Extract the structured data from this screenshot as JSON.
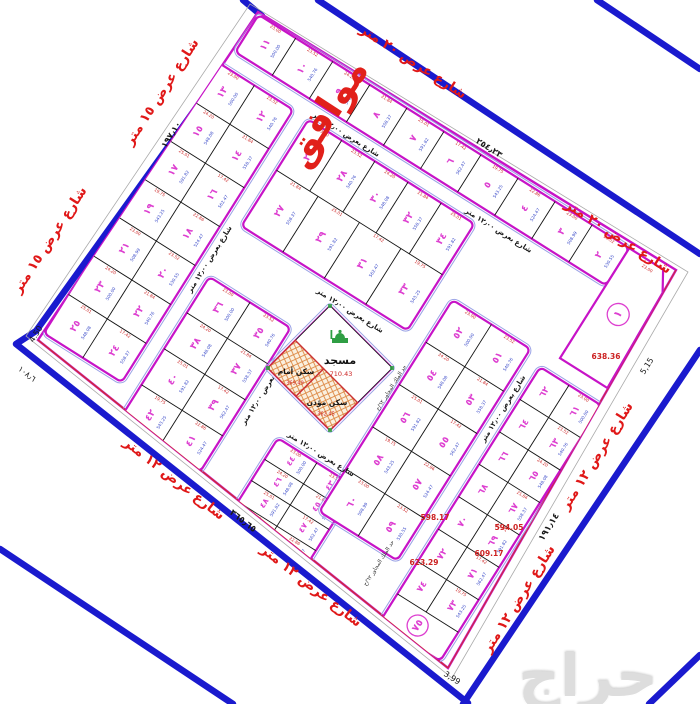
{
  "map": {
    "approval_stamp": "موافق",
    "watermark": "حراج",
    "street_names": {
      "top_20m": "شارع عرض ٢٠ متر",
      "left_15m": "شارع عرض ١٥ متر",
      "bottom_12m": "شارع عرض ١٢ متر",
      "right_12m": "شارع عرض ١٢ متر",
      "internal_12m": "شارع بعرض ١٢٫٠٠ متر"
    },
    "boundary_note": "حد الملك المجاور ٦٢/ح",
    "edge_measurements": {
      "top": "٢٥٤٫٢٣",
      "left": "١٩٧٫١٠",
      "bottom": "٣٦٥٫٦٥",
      "bottom_near_corner": "١٠٨٫٦",
      "right": "١٩١٫١٤",
      "corner_right": "5,15",
      "corner_bottom": "3,99",
      "corner_left": "4.50"
    },
    "mosque": {
      "label": "مسجد",
      "area": "710.43",
      "imam_house": "سكن أمام",
      "imam_area": "369.49",
      "muezzin_house": "سكن مؤذن",
      "muezzin_area": "362.45"
    },
    "blocks": {
      "top_row": [
        "١١",
        "١٠",
        "٩",
        "٨",
        "٧",
        "٦",
        "٥",
        "٤",
        "٣",
        "٢"
      ],
      "corner_plot": "١",
      "left_strip": [
        [
          "١٣",
          "١٢"
        ],
        [
          "١٥",
          "١٤"
        ],
        [
          "١٧",
          "١٦"
        ],
        [
          "١٩",
          "١٨"
        ],
        [
          "٢١",
          "٢٠"
        ],
        [
          "٢٣",
          "٢٢"
        ],
        [
          "٢٥",
          "٢٤"
        ]
      ],
      "mid_upper_top": [
        "٢٦",
        "٢٨",
        "٣٠",
        "٣٢",
        "٣٤"
      ],
      "mid_upper_bottom": [
        "٢٧",
        "٢٩",
        "٣١",
        "٣٣"
      ],
      "mid_lower": [
        [
          "٣٦",
          "٣٥"
        ],
        [
          "٣٨",
          "٣٧"
        ],
        [
          "٤٠",
          "٣٩"
        ],
        [
          "٤٢",
          "٤١"
        ]
      ],
      "south_mid": [
        [
          "٤٤",
          "٤٣"
        ],
        [
          "٤٦",
          "٤٥"
        ],
        [
          "٤٨",
          "٤٧"
        ],
        [
          "٥٠",
          "٤٩"
        ]
      ],
      "east_mid": [
        [
          "٥٢",
          "٥١"
        ],
        [
          "٥٤",
          "٥٣"
        ],
        [
          "٥٦",
          "٥٥"
        ],
        [
          "٥٨",
          "٥٧"
        ],
        [
          "٦٠",
          "٥٩"
        ]
      ],
      "east_strip": [
        [
          "٦٢",
          "٦١"
        ],
        [
          "٦٤",
          "٦٣"
        ],
        [
          "٦٦",
          "٦٥"
        ],
        [
          "٦٨",
          "٦٧"
        ],
        [
          "٧٠",
          "٦٩"
        ],
        [
          "٧٢",
          "٧١"
        ],
        [
          "٧٤",
          "٧٣"
        ]
      ],
      "east_strip_end": "٧٥"
    },
    "highlight_areas": [
      {
        "text": "638.36",
        "x": 606,
        "y": 357
      },
      {
        "text": "594.05",
        "x": 509,
        "y": 528
      },
      {
        "text": "598.17",
        "x": 435,
        "y": 518
      },
      {
        "text": "609.17",
        "x": 489,
        "y": 554
      },
      {
        "text": "623.29",
        "x": 424,
        "y": 563
      }
    ],
    "sample_dims": [
      "23.00",
      "23.52",
      "24.20",
      "21.84",
      "25.01",
      "17.42",
      "19.75",
      "22.86"
    ],
    "sample_areas": [
      "500.00",
      "540.76",
      "548.08",
      "558.37",
      "591.82",
      "562.47",
      "543.25",
      "524.47",
      "508.99",
      "530.55"
    ],
    "colors": {
      "street_line": "#1a1ace",
      "block_border": "#c713c7",
      "block_outline": "#9aa2e6",
      "plot_number": "#dd3fd0",
      "street_label": "#e01818",
      "dim": "#cc2222",
      "area": "#3949c8",
      "mosque_icon": "#2f9e44",
      "watermark": "#dcdcdc"
    }
  }
}
